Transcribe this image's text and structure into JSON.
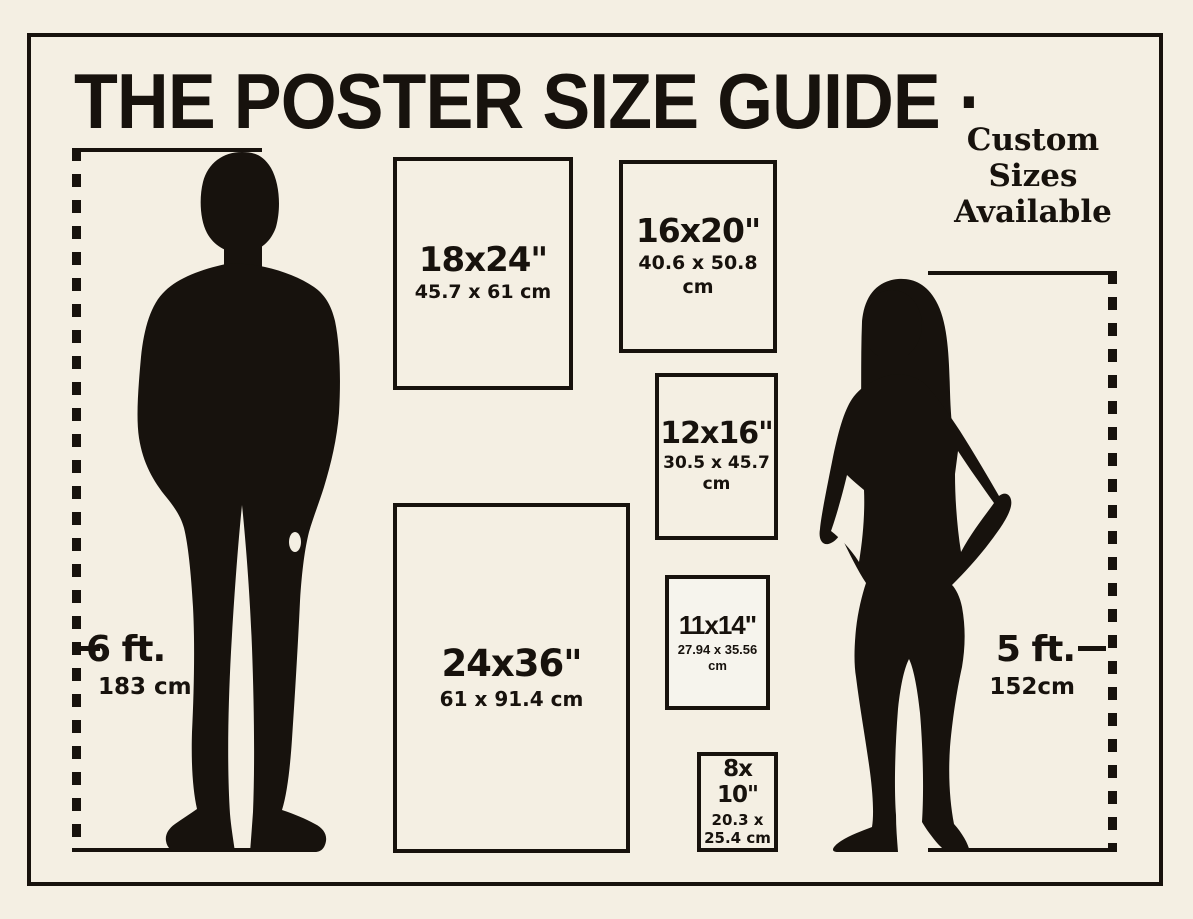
{
  "title": "THE POSTER SIZE GUIDE ·",
  "subtitle": {
    "line1": "Custom",
    "line2": "Sizes",
    "line3": "Available"
  },
  "colors": {
    "background": "#f4efe3",
    "ink": "#17120d"
  },
  "measurements": {
    "left": {
      "feet": "6 ft.",
      "cm": "183 cm"
    },
    "right": {
      "feet": "5 ft.",
      "cm": "152cm"
    }
  },
  "posters": [
    {
      "id": "18x24",
      "size_label": "18x24\"",
      "metric_label": "45.7 x 61 cm"
    },
    {
      "id": "16x20",
      "size_label": "16x20\"",
      "metric_label": "40.6 x 50.8 cm"
    },
    {
      "id": "12x16",
      "size_label": "12x16\"",
      "metric_label": "30.5 x 45.7 cm"
    },
    {
      "id": "11x14",
      "size_label": "11x14\"",
      "metric_label": "27.94 x 35.56 cm"
    },
    {
      "id": "24x36",
      "size_label": "24x36\"",
      "metric_label": "61 x 91.4 cm"
    },
    {
      "id": "8x10",
      "size_lines": [
        "8x",
        "10\""
      ],
      "metric_lines": [
        "20.3 x",
        "25.4 cm"
      ]
    }
  ],
  "figures": {
    "man": "man silhouette - 6 ft reference",
    "woman": "woman silhouette - 5 ft reference"
  }
}
